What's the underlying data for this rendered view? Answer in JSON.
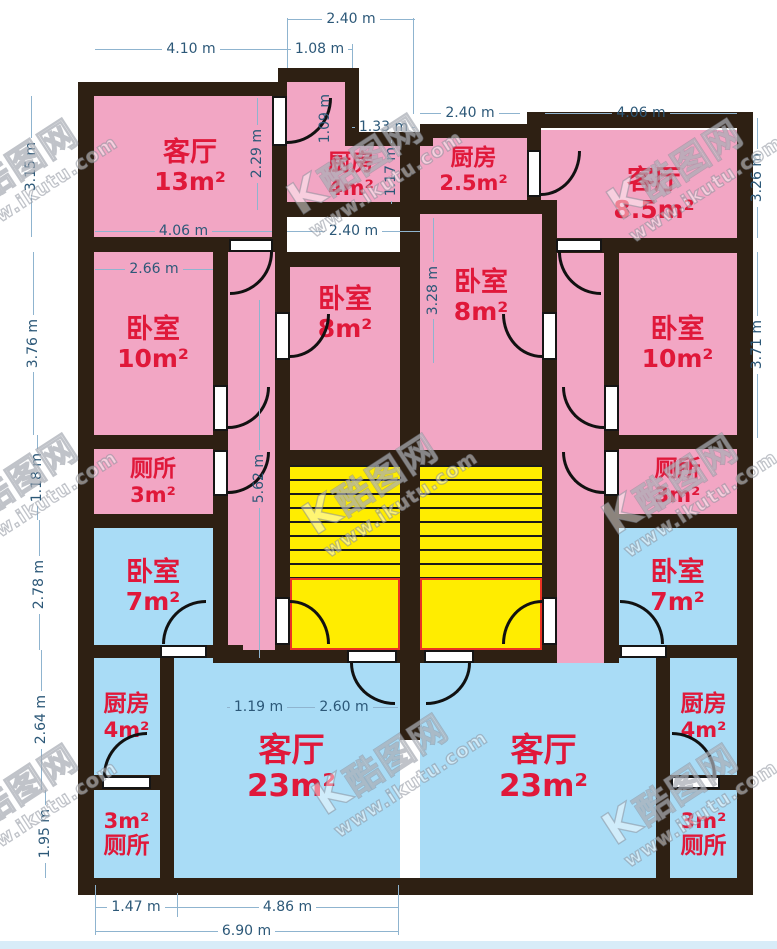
{
  "watermark": {
    "logo_mark": "K",
    "site_name": "酷图网",
    "site_url": "www.ikutu.com"
  },
  "colors": {
    "room_pink": "#F2A6C4",
    "room_blue": "#A9DCF6",
    "stairs_yellow": "#FFED00",
    "wall_dark": "#2E2013",
    "label_red": "#E0183A",
    "dim_blue": "#2C5878",
    "dim_line": "#8FB4CF",
    "stair_landing_red": "#EA3323"
  },
  "rooms": [
    {
      "name": "客厅",
      "area": "13m²"
    },
    {
      "name": "厨房",
      "area": "4m²"
    },
    {
      "name": "厨房",
      "area": "2.5m²"
    },
    {
      "name": "客厅",
      "area": "8.5m²"
    },
    {
      "name": "卧室",
      "area": "8m²"
    },
    {
      "name": "卧室",
      "area": "8m²"
    },
    {
      "name": "卧室",
      "area": "10m²"
    },
    {
      "name": "卧室",
      "area": "10m²"
    },
    {
      "name": "厕所",
      "area": "3m²"
    },
    {
      "name": "厕所",
      "area": "3m²"
    },
    {
      "name": "卧室",
      "area": "7m²"
    },
    {
      "name": "卧室",
      "area": "7m²"
    },
    {
      "name": "厨房",
      "area": "4m²"
    },
    {
      "name": "厨房",
      "area": "4m²"
    },
    {
      "name": "厕所",
      "area": "3m²"
    },
    {
      "name": "厕所",
      "area": "3m²"
    },
    {
      "name": "客厅",
      "area": "23m²"
    },
    {
      "name": "客厅",
      "area": "23m²"
    }
  ],
  "dims": [
    {
      "text": "4.10 m"
    },
    {
      "text": "2.40 m"
    },
    {
      "text": "1.08 m"
    },
    {
      "text": "2.40 m"
    },
    {
      "text": "4.06 m"
    },
    {
      "text": "1.33 m"
    },
    {
      "text": "4.06 m"
    },
    {
      "text": "2.40 m"
    },
    {
      "text": "2.66 m"
    },
    {
      "text": "1.19 m"
    },
    {
      "text": "2.60 m"
    },
    {
      "text": "1.47 m"
    },
    {
      "text": "4.86 m"
    },
    {
      "text": "6.90 m"
    },
    {
      "text": "3.15 m"
    },
    {
      "text": "3.76 m"
    },
    {
      "text": "1.18 m"
    },
    {
      "text": "2.78 m"
    },
    {
      "text": "2.64 m"
    },
    {
      "text": "1.95 m"
    },
    {
      "text": "2.29 m"
    },
    {
      "text": "1.09 m"
    },
    {
      "text": "1.17 m"
    },
    {
      "text": "3.28 m"
    },
    {
      "text": "5.62 m"
    },
    {
      "text": "3.26 m"
    },
    {
      "text": "3.71 m"
    }
  ]
}
